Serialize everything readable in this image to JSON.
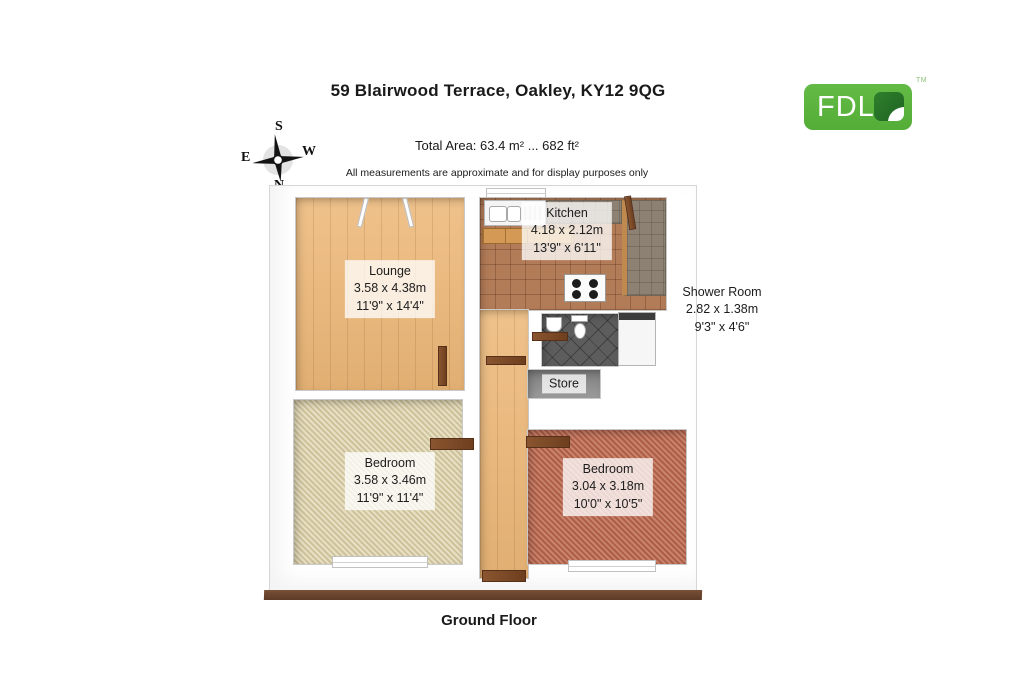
{
  "header": {
    "title": "59 Blairwood Terrace, Oakley, KY12 9QG",
    "total_area": "Total Area: 63.4 m² ... 682 ft²",
    "disclaimer": "All measurements are approximate and for display purposes only"
  },
  "footer": {
    "floor_label": "Ground Floor"
  },
  "compass": {
    "n": "N",
    "s": "S",
    "e": "E",
    "w": "W"
  },
  "logo": {
    "text": "FDL",
    "tm": "TM",
    "green": "#58b43e",
    "leaf_green": "#256f28"
  },
  "rooms": {
    "lounge": {
      "name": "Lounge",
      "metric": "3.58 x 4.38m",
      "imperial": "11'9\" x 14'4\""
    },
    "kitchen": {
      "name": "Kitchen",
      "metric": "4.18 x 2.12m",
      "imperial": "13'9\" x 6'11\""
    },
    "shower_room": {
      "name": "Shower Room",
      "metric": "2.82 x 1.38m",
      "imperial": "9'3\" x 4'6\""
    },
    "store": {
      "name": "Store"
    },
    "bedroom_left": {
      "name": "Bedroom",
      "metric": "3.58 x 3.46m",
      "imperial": "11'9\" x 11'4\""
    },
    "bedroom_right": {
      "name": "Bedroom",
      "metric": "3.04 x 3.18m",
      "imperial": "10'0\" x 10'5\""
    }
  }
}
